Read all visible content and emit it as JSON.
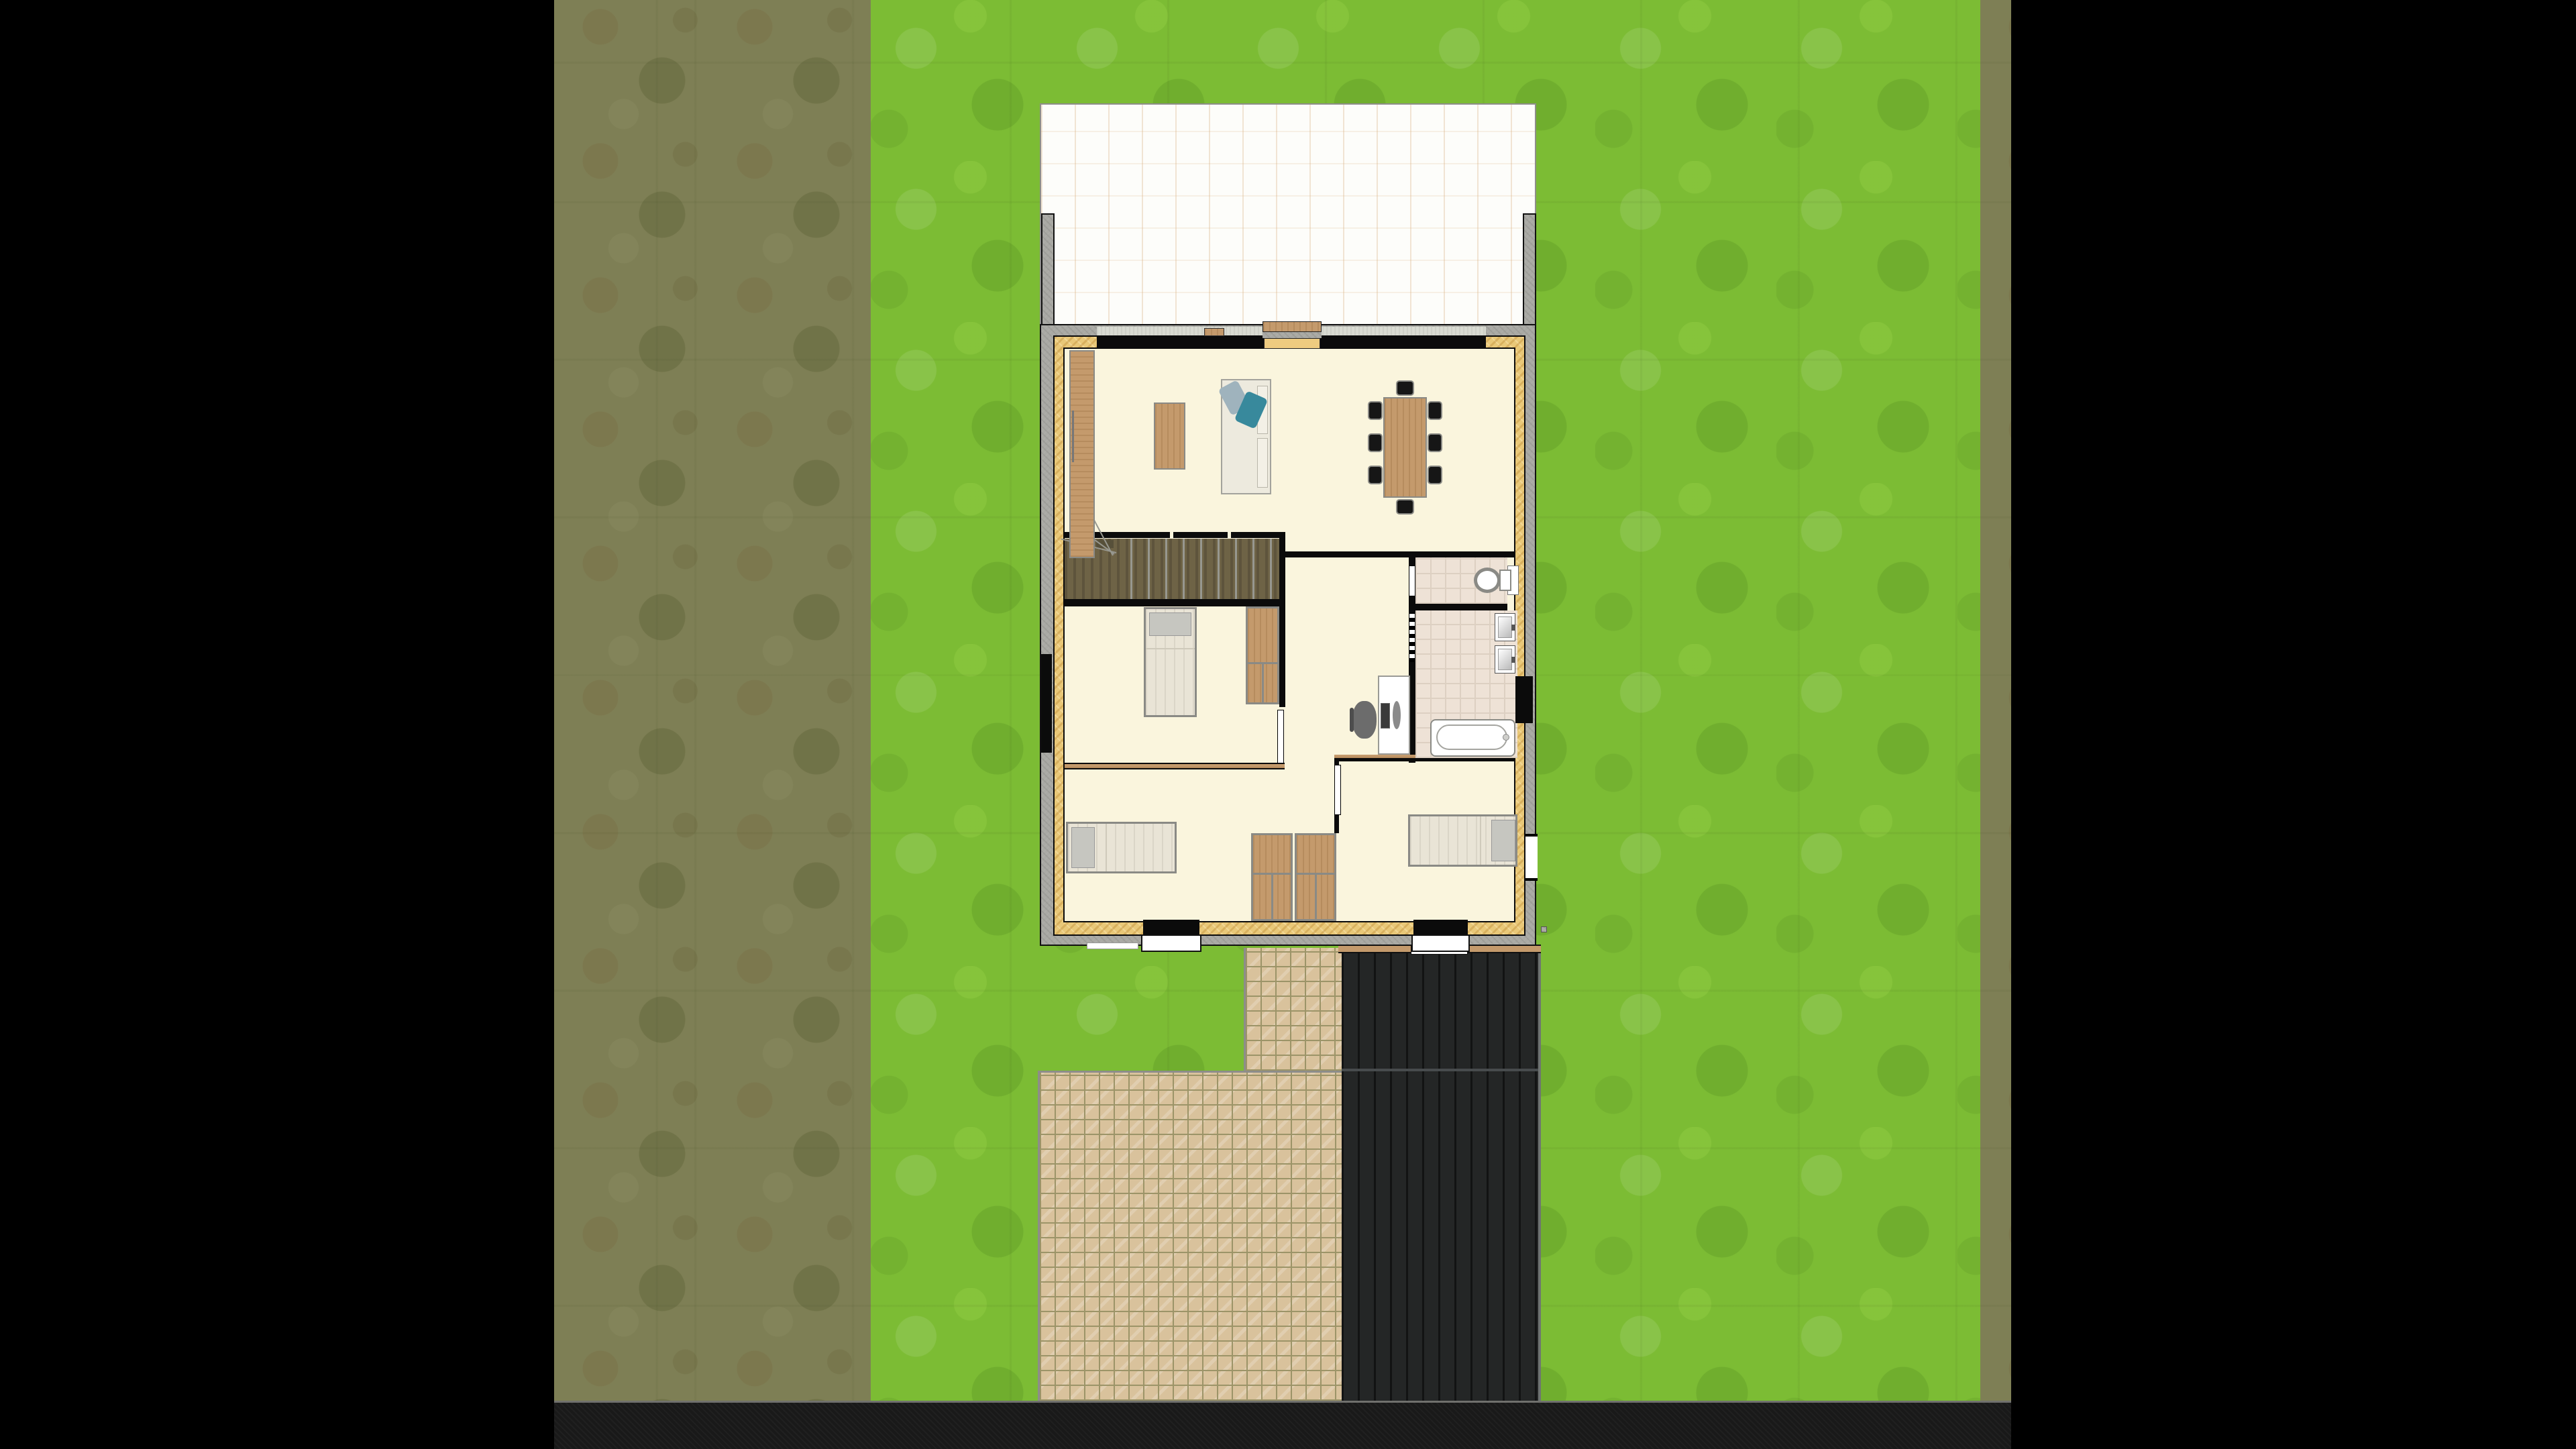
{
  "scene": {
    "kind": "2D floor-plan site view (home design app render)",
    "letterbox": "black side bars",
    "site_areas": [
      {
        "name": "field-strip-left"
      },
      {
        "name": "lawn"
      },
      {
        "name": "field-strip-right"
      },
      {
        "name": "road-bottom"
      },
      {
        "name": "paved-path"
      },
      {
        "name": "paved-patio"
      },
      {
        "name": "dark-driveway-carport"
      },
      {
        "name": "roof-terrace-white"
      }
    ],
    "house": {
      "rooms": [
        {
          "name": "living-dining-room"
        },
        {
          "name": "staircase"
        },
        {
          "name": "bedroom-middle-left"
        },
        {
          "name": "hallway-study"
        },
        {
          "name": "toilet-room"
        },
        {
          "name": "bathroom"
        },
        {
          "name": "bedroom-bottom-left"
        },
        {
          "name": "bedroom-bottom-right"
        }
      ],
      "furniture": [
        "sideboard",
        "coffee-table",
        "sofa-with-pillows",
        "dining-table",
        "eight-chairs",
        "single-bed-vertical",
        "wardrobe",
        "single-bed-left",
        "single-bed-right",
        "double-wardrobe",
        "desk",
        "computer",
        "office-chair",
        "two-washbasins",
        "bathtub",
        "toilet"
      ]
    }
  },
  "palette": {
    "black-bar": "#000000",
    "grass": "#7cbc34",
    "field": "#7e7f55",
    "road": "#191919",
    "driveway": "#242626",
    "driveway-divider": "#474b4d",
    "driveway-edge": "#6f7472",
    "tile": "#d9c29c",
    "tile-grout": "#9c9468",
    "roof": "#fdfdfa",
    "concrete": "#a9a9a4",
    "band": "#d9dbd2",
    "insulation": "#e9c878",
    "wall": "#0b0b0b",
    "floor": "#faf5dd",
    "bathtile": "#eee2d6",
    "bathtile-line": "#ddd0c2",
    "stairs": "#6e6346",
    "stairs-line": "#97978f",
    "wood": "#c49a6c",
    "frame": "#8a8a85",
    "linen": "#e9e4d6",
    "pillow": "#c6c6c0",
    "sofa": "#edeade",
    "pillow-blue": "#9fb3bd",
    "pillow-teal": "#38899c",
    "chair-black": "#161616",
    "fixture-white": "#ffffff",
    "desk-gray": "#6c6c6c"
  }
}
